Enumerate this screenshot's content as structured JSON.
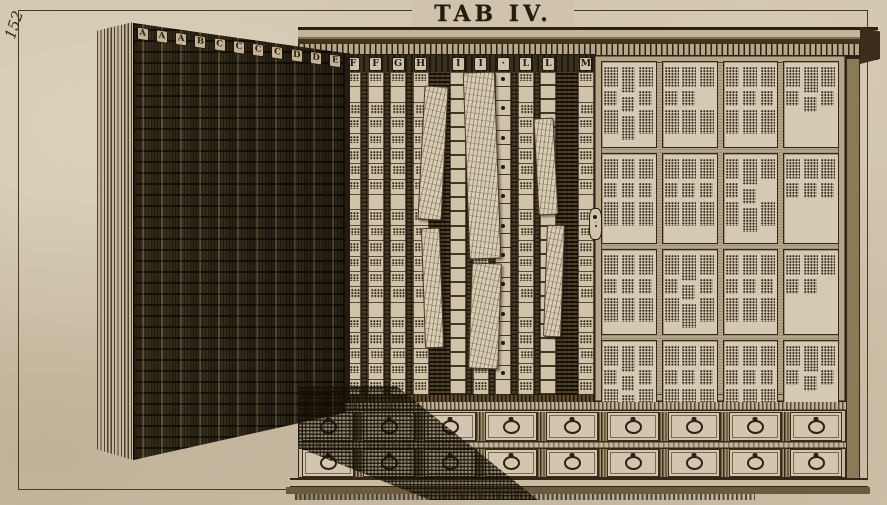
{
  "plate": {
    "title": "TAB IV.",
    "page_number": "152"
  },
  "colors": {
    "paper": "#cfc3ab",
    "ink": "#241c10",
    "wood_dark": "#5d4f33",
    "pane_bg": "#d4c9b2"
  },
  "icons": {
    "drawer_pull": "ring-pull-icon",
    "keyhole": "keyhole-escutcheon-icon"
  },
  "cabinet": {
    "door_letters": [
      "A",
      "A",
      "A",
      "B",
      "C",
      "C",
      "C",
      "C",
      "D",
      "D",
      "E"
    ],
    "interior_columns": [
      {
        "type": "labels",
        "letter": "F"
      },
      {
        "type": "rail",
        "letter": ""
      },
      {
        "type": "labels",
        "letter": "F"
      },
      {
        "type": "rail",
        "letter": ""
      },
      {
        "type": "labels",
        "letter": "G"
      },
      {
        "type": "rail",
        "letter": ""
      },
      {
        "type": "labels",
        "letter": "H"
      },
      {
        "type": "wide",
        "letter": ""
      },
      {
        "type": "ladder",
        "letter": "I"
      },
      {
        "type": "rail",
        "letter": ""
      },
      {
        "type": "labels",
        "letter": "I"
      },
      {
        "type": "rail",
        "letter": ""
      },
      {
        "type": "dots",
        "letter": "·"
      },
      {
        "type": "rail",
        "letter": ""
      },
      {
        "type": "labels",
        "letter": "L"
      },
      {
        "type": "rail",
        "letter": ""
      },
      {
        "type": "ladder",
        "letter": "L"
      },
      {
        "type": "wide",
        "letter": ""
      },
      {
        "type": "labels",
        "letter": "M"
      }
    ],
    "interior_cells_per_column": 21,
    "specimens": [
      {
        "x": 421,
        "y": 86,
        "w": 22,
        "h": 132,
        "rot": 3
      },
      {
        "x": 423,
        "y": 228,
        "w": 17,
        "h": 118,
        "rot": -2
      },
      {
        "x": 466,
        "y": 72,
        "w": 30,
        "h": 185,
        "rot": -2
      },
      {
        "x": 470,
        "y": 263,
        "w": 28,
        "h": 104,
        "rot": 2
      },
      {
        "x": 536,
        "y": 118,
        "w": 18,
        "h": 95,
        "rot": -3
      },
      {
        "x": 545,
        "y": 225,
        "w": 16,
        "h": 110,
        "rot": 2
      }
    ],
    "right_door": {
      "pane_rows": 4,
      "pane_cols": 4,
      "pane_text_cols": 3,
      "blocks_per_pane_col": 3
    },
    "drawers": {
      "rows": [
        {
          "count": 9
        },
        {
          "count": 9
        }
      ]
    }
  }
}
